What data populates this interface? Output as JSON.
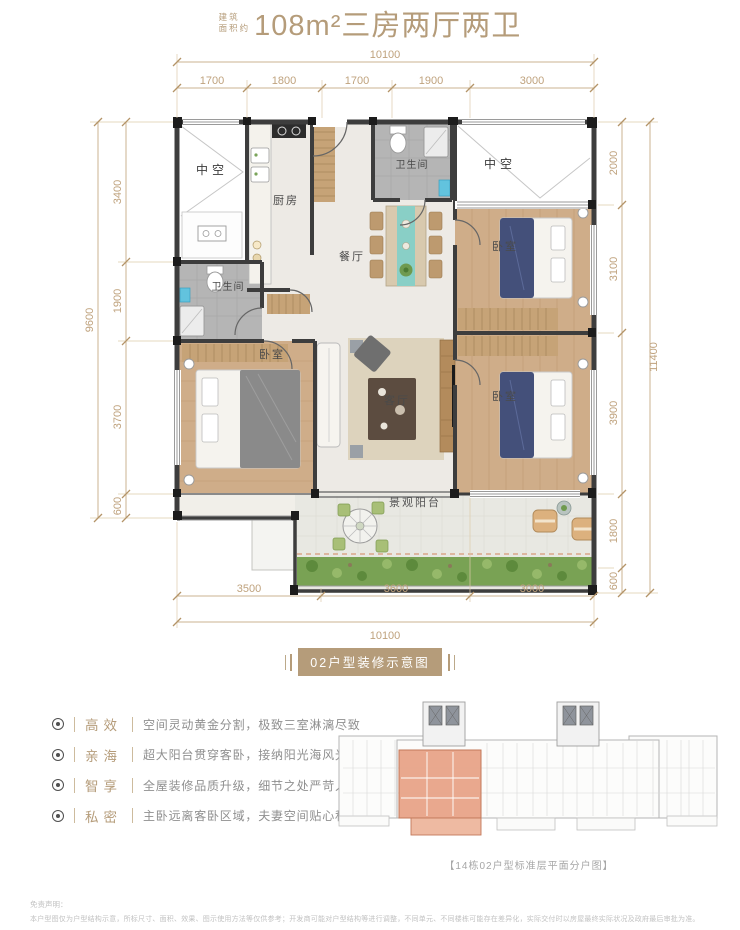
{
  "title": {
    "prefix_top": "建筑",
    "prefix_bottom": "面积约",
    "main": "108m²三房两厅两卫"
  },
  "plan": {
    "dims": {
      "top_total": "10100",
      "top_segments": [
        "1700",
        "1800",
        "1700",
        "1900",
        "3000"
      ],
      "left_total": "9600",
      "left_segments": [
        "3400",
        "1900",
        "3700",
        "600"
      ],
      "right_total": "11400",
      "right_segments": [
        "2000",
        "3100",
        "3900",
        "1800",
        "600"
      ],
      "bottom_segments": [
        "3500",
        "3600",
        "3000"
      ],
      "bottom_total": "10100"
    },
    "rooms": {
      "void_top_left": "中空",
      "kitchen": "厨房",
      "bath_top": "卫生间",
      "void_top_right": "中空",
      "dining": "餐厅",
      "bedroom_right_top": "卧室",
      "bath_left": "卫生间",
      "bedroom_left": "卧室",
      "living": "客厅",
      "bedroom_right_bottom": "卧室",
      "balcony": "景观阳台"
    }
  },
  "badge": "02户型装修示意图",
  "features": [
    {
      "label": "高效",
      "text": "空间灵动黄金分割，极致三室淋漓尽致"
    },
    {
      "label": "亲海",
      "text": "超大阳台贯穿客卧，接纳阳光海风光临"
    },
    {
      "label": "智享",
      "text": "全屋装修品质升级，细节之处严苛入微"
    },
    {
      "label": "私密",
      "text": "主卧远离客卧区域，夫妻空间贴心私密"
    }
  ],
  "keyplan_caption": "【14栋02户型标准层平面分户图】",
  "disclaimer": {
    "title": "免责声明：",
    "body": "本户型图仅为户型结构示意，所标尺寸、面积、效果、图示使用方法等仅供参考；开发商可能对户型结构等进行调整，不同单元、不同楼栋可能存在差异化，实际交付时以房屋最终实际状况及政府最后审批为准。"
  },
  "colors": {
    "accent": "#b59c7a",
    "dim_line": "#cbb392",
    "dim_text": "#bfa27d",
    "wall": "#3d3d3d",
    "wood": "#cfad89",
    "marble": "#edeae5",
    "tile_gray": "#b5b5b5",
    "grass": "#79a254",
    "teal": "#62c3de",
    "highlight_unit": "#e7a184"
  }
}
